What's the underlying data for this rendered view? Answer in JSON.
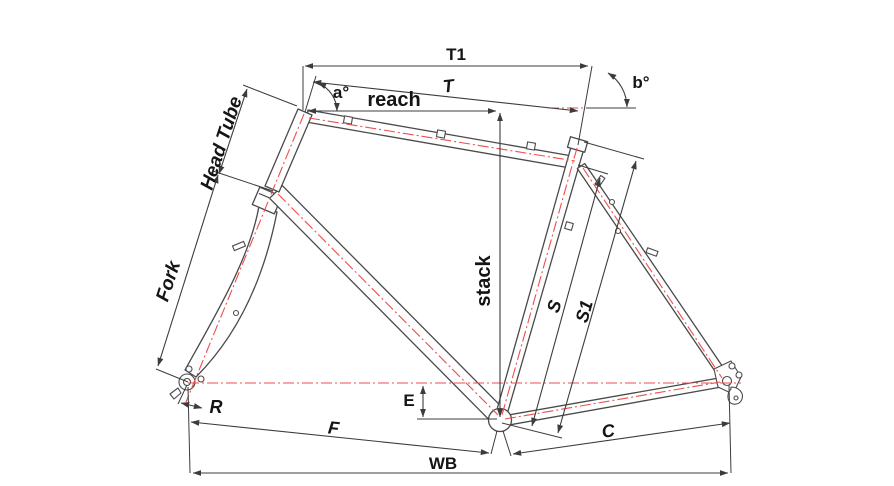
{
  "diagram": {
    "colors": {
      "accent_red": "#ee4d4d",
      "line_dark": "#3c3c3c",
      "background": "#ffffff"
    },
    "labels": {
      "t1": "T1",
      "t": "T",
      "reach": "reach",
      "angle_a": "a°",
      "angle_b": "b°",
      "head_tube": "Head Tube",
      "fork": "Fork",
      "stack": "stack",
      "s": "S",
      "s1": "S1",
      "r": "R",
      "e": "E",
      "f": "F",
      "c": "C",
      "wb": "WB"
    }
  }
}
